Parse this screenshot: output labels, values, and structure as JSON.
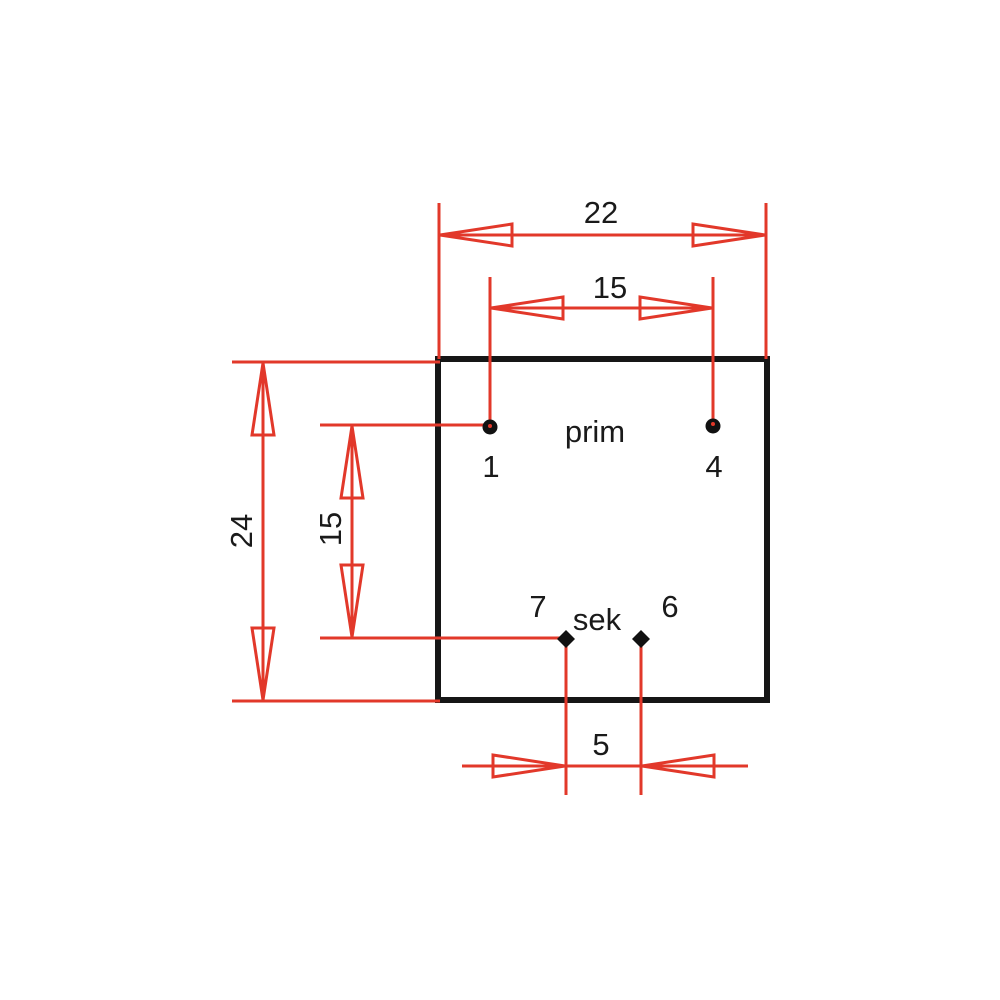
{
  "diagram": {
    "type": "transformer-footprint-dimension-drawing",
    "colors": {
      "dimension_red": "#e2382a",
      "outline_black": "#161616",
      "text_black": "#1a1a1a",
      "background": "#ffffff"
    },
    "dimensions": {
      "body_width": "22",
      "primary_pin_spacing": "15",
      "body_height": "24",
      "row_spacing": "15",
      "secondary_pin_spacing": "5"
    },
    "windings": {
      "primary_label": "prim",
      "secondary_label": "sek"
    },
    "pins": {
      "pin1": "1",
      "pin4": "4",
      "pin7": "7",
      "pin6": "6"
    }
  }
}
